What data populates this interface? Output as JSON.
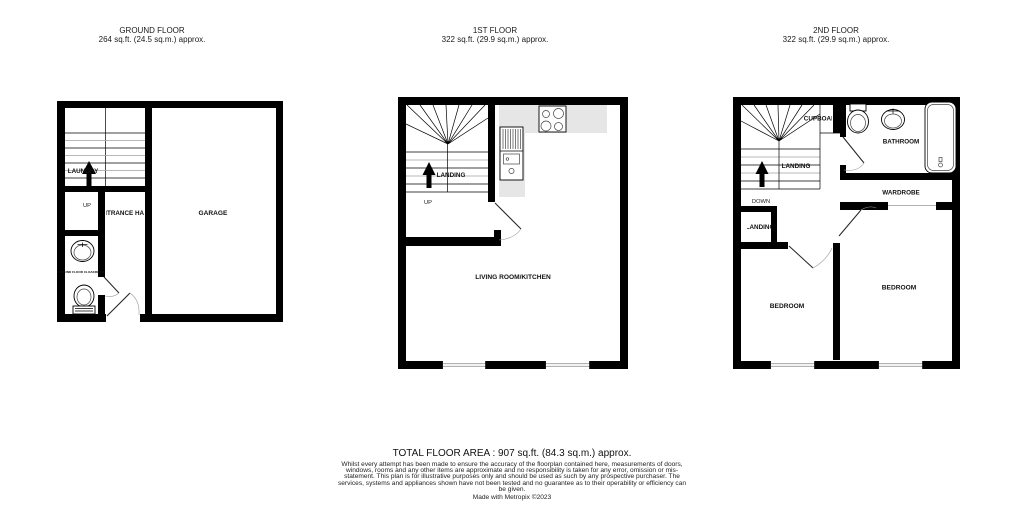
{
  "floors": {
    "ground": {
      "title": "GROUND FLOOR",
      "area": "264 sq.ft. (24.5 sq.m.) approx.",
      "rooms": {
        "laundry": "LAUNDRY",
        "up": "UP",
        "entrance_hall": "ENTRANCE HALL",
        "garage": "GARAGE",
        "cloakroom": "GROUND FLOOR CLOAKROOM"
      }
    },
    "first": {
      "title": "1ST FLOOR",
      "area": "322 sq.ft. (29.9 sq.m.) approx.",
      "rooms": {
        "landing": "LANDING",
        "up": "UP",
        "living_kitchen": "LIVING ROOM/KITCHEN"
      }
    },
    "second": {
      "title": "2ND FLOOR",
      "area": "322 sq.ft. (29.9 sq.m.) approx.",
      "rooms": {
        "cupboard": "CUPBOARD",
        "landing": "LANDING",
        "down": "DOWN",
        "landing_small": "LANDING",
        "bathroom": "BATHROOM",
        "wardrobe": "WARDROBE",
        "bedroom_left": "BEDROOM",
        "bedroom_right": "BEDROOM"
      }
    }
  },
  "footer": {
    "total": "TOTAL FLOOR AREA : 907 sq.ft. (84.3 sq.m.) approx.",
    "disclaimer": "Whilst every attempt has been made to ensure the accuracy of the floorplan contained here, measurements of doors, windows, rooms and any other items are approximate and no responsibility is taken for any error, omission or mis-statement. This plan is for illustrative purposes only and should be used as such by any prospective purchaser. The services, systems and appliances shown have not been tested and no guarantee as to their operability or efficiency can be given.",
    "credit": "Made with Metropix ©2023"
  },
  "colors": {
    "wall": "#000000",
    "counter": "#e6e6e6",
    "muted_line": "#999999",
    "background": "#ffffff"
  }
}
